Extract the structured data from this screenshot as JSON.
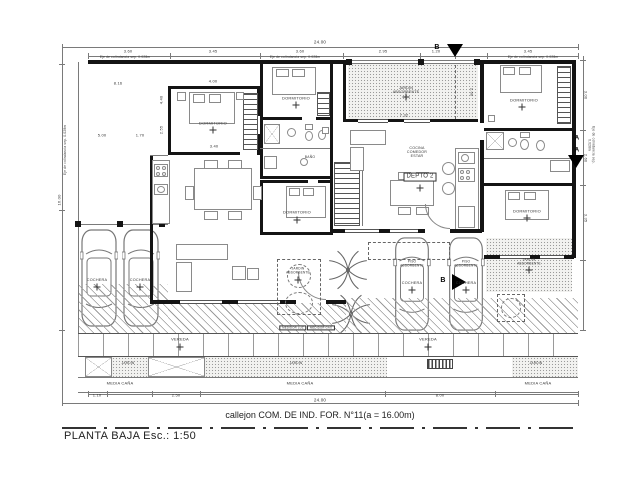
{
  "title": "PLANTA BAJA  Esc.: 1:50",
  "street_label": "callejon COM. DE IND. FOR. N°11(a = 16.00m)",
  "colors": {
    "wall": "#141414",
    "thin_line": "#7a7a7a",
    "text": "#333333",
    "paper": "#ffffff"
  },
  "labels": [
    {
      "n": "dim-total-top",
      "t": "24.00",
      "x": 320,
      "y": 42,
      "s": 4.5
    },
    {
      "n": "dim-label",
      "t": "3.60",
      "x": 128,
      "y": 52,
      "s": 4
    },
    {
      "n": "dim-label",
      "t": "3.45",
      "x": 213,
      "y": 52,
      "s": 4
    },
    {
      "n": "dim-label",
      "t": "3.60",
      "x": 300,
      "y": 52,
      "s": 4
    },
    {
      "n": "dim-label",
      "t": "2.95",
      "x": 383,
      "y": 52,
      "s": 4
    },
    {
      "n": "dim-label",
      "t": "1.20",
      "x": 436,
      "y": 52,
      "s": 4
    },
    {
      "n": "dim-label",
      "t": "3.45",
      "x": 528,
      "y": 52,
      "s": 4
    },
    {
      "n": "boundary-note",
      "t": "Eje de colindancia sep. 0.028m",
      "x": 125,
      "y": 57.5,
      "s": 3.2
    },
    {
      "n": "boundary-note",
      "t": "Eje de colindancia sep. 0.028m",
      "x": 295,
      "y": 57.5,
      "s": 3.2
    },
    {
      "n": "boundary-note",
      "t": "Eje de colindancia sep. 0.028m",
      "x": 533,
      "y": 57.5,
      "s": 3.2
    },
    {
      "n": "boundary-note",
      "t": "Eje de colindancia sep. 0.028m",
      "x": 66,
      "y": 150,
      "s": 3.2,
      "rot": -90
    },
    {
      "n": "boundary-note",
      "t": "Eje de colindancia sep. 0.028m",
      "x": 591,
      "y": 145,
      "s": 3.2,
      "rot": 90
    },
    {
      "n": "dim-label",
      "t": "8.16",
      "x": 118,
      "y": 84,
      "s": 4
    },
    {
      "n": "dim-label",
      "t": "5.00",
      "x": 102,
      "y": 136,
      "s": 4
    },
    {
      "n": "dim-label",
      "t": "1.70",
      "x": 140,
      "y": 136,
      "s": 4
    },
    {
      "n": "dim-label",
      "t": "16.00",
      "x": 60,
      "y": 200,
      "s": 4,
      "rot": -90
    },
    {
      "n": "dim-label",
      "t": "4.00",
      "x": 213,
      "y": 82,
      "s": 4
    },
    {
      "n": "dim-label",
      "t": "3.40",
      "x": 214,
      "y": 147,
      "s": 4
    },
    {
      "n": "dim-label",
      "t": "4.40",
      "x": 162,
      "y": 100,
      "s": 4,
      "rot": -90
    },
    {
      "n": "dim-label",
      "t": "2.55",
      "x": 162,
      "y": 130,
      "s": 4,
      "rot": -90
    },
    {
      "n": "room-label",
      "t": "DORMITORIO",
      "x": 213,
      "y": 124,
      "s": 4
    },
    {
      "n": "room-label",
      "t": "DORMITORIO",
      "x": 296,
      "y": 99,
      "s": 4
    },
    {
      "n": "room-label",
      "t": "DORMITORIO",
      "x": 297,
      "y": 213,
      "s": 4
    },
    {
      "n": "room-label",
      "t": "BAÑO",
      "x": 310,
      "y": 158,
      "s": 3.4
    },
    {
      "n": "room-label",
      "t": "DORMITORIO",
      "x": 524,
      "y": 101,
      "s": 4
    },
    {
      "n": "room-label",
      "t": "DORMITORIO",
      "x": 527,
      "y": 212,
      "s": 4
    },
    {
      "n": "room-label",
      "t": "COCINA\nCOMEDOR\nESTAR",
      "x": 417,
      "y": 152,
      "s": 3.6
    },
    {
      "n": "unit-label",
      "t": "DEPTO 2",
      "x": 420,
      "y": 177,
      "s": 6,
      "boxed": true
    },
    {
      "n": "area-label",
      "t": "JARDIN\nABSORBENTE",
      "x": 406,
      "y": 90,
      "s": 3.6
    },
    {
      "n": "dim-label",
      "t": "7.32",
      "x": 404,
      "y": 116,
      "s": 4
    },
    {
      "n": "dim-label",
      "t": "2.60",
      "x": 471,
      "y": 92,
      "s": 4,
      "rot": 90
    },
    {
      "n": "area-label",
      "t": "COCHERA",
      "x": 97,
      "y": 280,
      "s": 3.8
    },
    {
      "n": "area-label",
      "t": "COCHERA",
      "x": 140,
      "y": 280,
      "s": 3.8
    },
    {
      "n": "area-label",
      "t": "PISO\nABSORBENTE",
      "x": 412,
      "y": 264,
      "s": 3.2
    },
    {
      "n": "area-label",
      "t": "COCHERA",
      "x": 412,
      "y": 283,
      "s": 3.8
    },
    {
      "n": "area-label",
      "t": "PISO\nABSORBENTE",
      "x": 466,
      "y": 264,
      "s": 3.2
    },
    {
      "n": "area-label",
      "t": "COCHERA",
      "x": 466,
      "y": 283,
      "s": 3.8
    },
    {
      "n": "area-label",
      "t": "JARDIN\nABSORBENTE",
      "x": 298,
      "y": 271,
      "s": 3.2
    },
    {
      "n": "area-label",
      "t": "JARDIN\nABSORBENTE",
      "x": 529,
      "y": 262,
      "s": 3.2
    },
    {
      "n": "meter-label",
      "t": "MEDIDOR LUZ",
      "x": 293,
      "y": 328,
      "s": 2.8,
      "boxed": true
    },
    {
      "n": "meter-label",
      "t": "MEDIDOR GAS",
      "x": 321,
      "y": 328,
      "s": 2.8,
      "boxed": true
    },
    {
      "n": "strip-label",
      "t": "VEREDA",
      "x": 180,
      "y": 340,
      "s": 4
    },
    {
      "n": "strip-label",
      "t": "VEREDA",
      "x": 428,
      "y": 340,
      "s": 4
    },
    {
      "n": "strip-label",
      "t": "JARDIN",
      "x": 128,
      "y": 364,
      "s": 3.2
    },
    {
      "n": "strip-label",
      "t": "JARDIN",
      "x": 296,
      "y": 364,
      "s": 3.2
    },
    {
      "n": "strip-label",
      "t": "JARDIN",
      "x": 536,
      "y": 364,
      "s": 3.2
    },
    {
      "n": "strip-label",
      "t": "MEDIA CAÑA",
      "x": 120,
      "y": 384,
      "s": 4
    },
    {
      "n": "strip-label",
      "t": "MEDIA CAÑA",
      "x": 300,
      "y": 384,
      "s": 4
    },
    {
      "n": "strip-label",
      "t": "MEDIA CAÑA",
      "x": 538,
      "y": 384,
      "s": 4
    },
    {
      "n": "dim-label",
      "t": "1.10",
      "x": 97,
      "y": 396,
      "s": 4
    },
    {
      "n": "dim-label",
      "t": "2.50",
      "x": 176,
      "y": 396,
      "s": 4
    },
    {
      "n": "dim-label",
      "t": "8.00",
      "x": 440,
      "y": 396,
      "s": 4
    },
    {
      "n": "dim-total-bottom",
      "t": "24.00",
      "x": 320,
      "y": 400,
      "s": 4.5
    },
    {
      "n": "section-letter",
      "t": "B",
      "x": 437,
      "y": 48,
      "s": 7,
      "bold": true
    },
    {
      "n": "section-letter",
      "t": "B",
      "x": 443,
      "y": 281,
      "s": 7,
      "bold": true
    },
    {
      "n": "section-letter",
      "t": "A",
      "x": 577,
      "y": 139,
      "s": 6,
      "bold": true
    },
    {
      "n": "section-letter",
      "t": "A",
      "x": 577,
      "y": 151,
      "s": 6,
      "bold": true
    },
    {
      "n": "dim-label",
      "t": "3.00",
      "x": 585,
      "y": 95,
      "s": 4,
      "rot": 90
    },
    {
      "n": "dim-label",
      "t": "2.60",
      "x": 585,
      "y": 158,
      "s": 4,
      "rot": 90
    },
    {
      "n": "dim-label",
      "t": "3.35",
      "x": 585,
      "y": 218,
      "s": 4,
      "rot": 90
    }
  ]
}
